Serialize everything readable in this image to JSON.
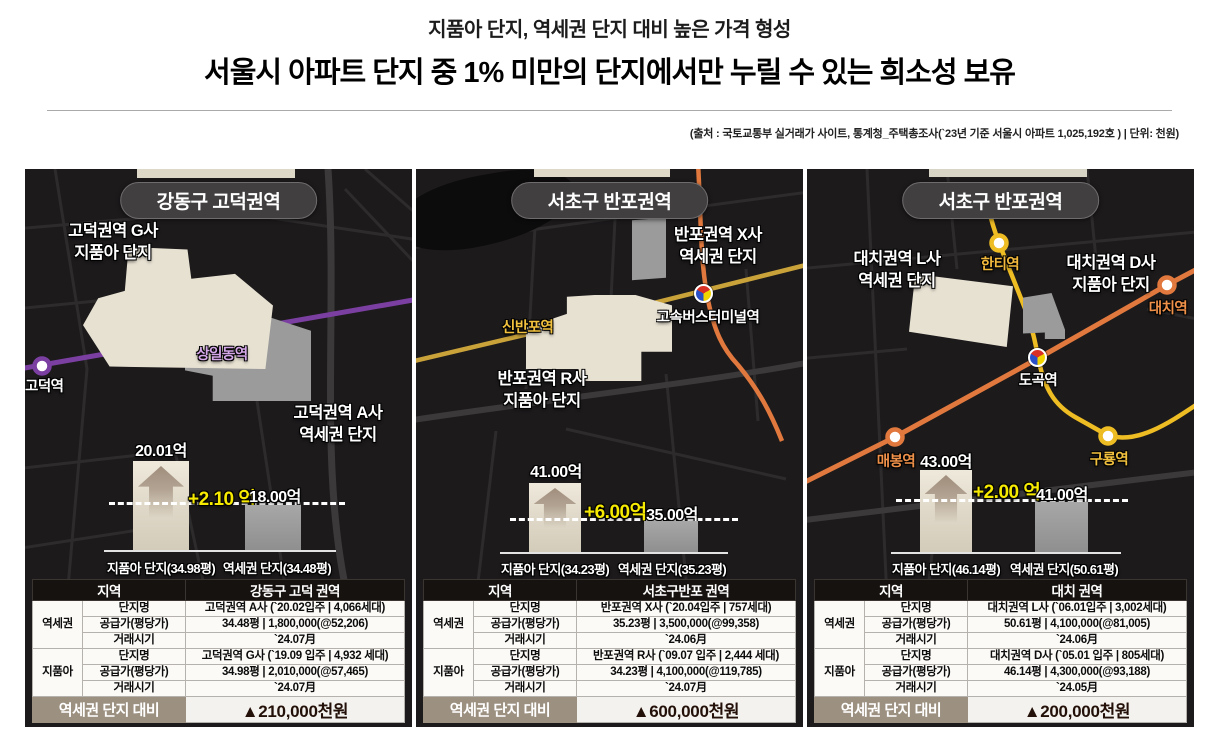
{
  "header": {
    "subtitle": "지품아 단지, 역세권 단지 대비 높은 가격 형성",
    "title": "서울시 아파트 단지 중 1% 미만의 단지에서만 누릴 수 있는 희소성 보유",
    "source": "(출처 : 국토교통부 실거래가 사이트, 통계청_주택총조사(`23년 기준 서울시 아파트 1,025,192호 ) | 단위: 천원)"
  },
  "colors": {
    "diff_highlight": "#f6ea00",
    "line_purple": "#7b3fa2",
    "line_gold": "#c9a23a",
    "line_yellow": "#eebc23",
    "line_orange": "#e1793e",
    "bar_premium_cream": "#e7e0d0",
    "bar_station_gray": "#9a9a9a",
    "table_footer_bg": "#9c9080",
    "map_bg": "#1c1a1b"
  },
  "panels": [
    {
      "title": "강동구 고덕권역",
      "map": {
        "area_labels": [
          {
            "text": "고덕권역 G사\n지품아 단지"
          },
          {
            "text": "고덕권역 A사\n역세권 단지"
          }
        ],
        "stations": [
          {
            "name": "고덕역"
          },
          {
            "name": "상일동역"
          }
        ]
      },
      "chart": {
        "left_value": "20.01억",
        "diff": "+2.10 억",
        "right_value": "18.00억",
        "left_label": "지품아 단지(34.98평)",
        "right_label": "역세권 단지(34.48평)"
      },
      "table": {
        "region_header": "지역",
        "region_value": "강동구 고덕 권역",
        "groups": [
          {
            "name": "역세권",
            "rows": [
              {
                "label": "단지명",
                "value": "고덕권역 A사 (`20.02입주 | 4,066세대)"
              },
              {
                "label": "공급가(평당가)",
                "value": "34.48평 | 1,800,000(@52,206)"
              },
              {
                "label": "거래시기",
                "value": "`24.07月"
              }
            ]
          },
          {
            "name": "지품아",
            "rows": [
              {
                "label": "단지명",
                "value": "고덕권역 G사 (`19.09 입주 | 4,932 세대)"
              },
              {
                "label": "공급가(평당가)",
                "value": "34.98평 | 2,010,000(@57,465)"
              },
              {
                "label": "거래시기",
                "value": "`24.07月"
              }
            ]
          }
        ],
        "footer_label": "역세권 단지 대비",
        "footer_value": "▲210,000천원"
      }
    },
    {
      "title": "서초구 반포권역",
      "map": {
        "area_labels": [
          {
            "text": "반포권역 X사\n역세권 단지"
          },
          {
            "text": "반포권역 R사\n지품아 단지"
          }
        ],
        "stations": [
          {
            "name": "신반포역"
          },
          {
            "name": "고속버스터미널역"
          }
        ]
      },
      "chart": {
        "left_value": "41.00억",
        "diff": "+6.00억",
        "right_value": "35.00억",
        "left_label": "지품아 단지(34.23평)",
        "right_label": "역세권 단지(35.23평)"
      },
      "table": {
        "region_header": "지역",
        "region_value": "서초구반포 권역",
        "groups": [
          {
            "name": "역세권",
            "rows": [
              {
                "label": "단지명",
                "value": "반포권역 X사 (`20.04입주 | 757세대)"
              },
              {
                "label": "공급가(평당가)",
                "value": "35.23평 | 3,500,000(@99,358)"
              },
              {
                "label": "거래시기",
                "value": "`24.06月"
              }
            ]
          },
          {
            "name": "지품아",
            "rows": [
              {
                "label": "단지명",
                "value": "반포권역 R사 (`09.07 입주 | 2,444 세대)"
              },
              {
                "label": "공급가(평당가)",
                "value": "34.23평 | 4,100,000(@119,785)"
              },
              {
                "label": "거래시기",
                "value": "`24.07月"
              }
            ]
          }
        ],
        "footer_label": "역세권 단지 대비",
        "footer_value": "▲600,000천원"
      }
    },
    {
      "title": "서초구 반포권역",
      "map": {
        "area_labels": [
          {
            "text": "대치권역 L사\n역세권 단지"
          },
          {
            "text": "대치권역 D사\n지품아 단지"
          }
        ],
        "stations": [
          {
            "name": "한티역"
          },
          {
            "name": "대치역"
          },
          {
            "name": "도곡역"
          },
          {
            "name": "매봉역"
          },
          {
            "name": "구룡역"
          }
        ]
      },
      "chart": {
        "left_value": "43.00억",
        "diff": "+2.00 억",
        "right_value": "41.00억",
        "left_label": "지품아 단지(46.14평)",
        "right_label": "역세권 단지(50.61평)"
      },
      "table": {
        "region_header": "지역",
        "region_value": "대치 권역",
        "groups": [
          {
            "name": "역세권",
            "rows": [
              {
                "label": "단지명",
                "value": "대치권역 L사 (`06.01입주 | 3,002세대)"
              },
              {
                "label": "공급가(평당가)",
                "value": "50.61평 | 4,100,000(@81,005)"
              },
              {
                "label": "거래시기",
                "value": "`24.06月"
              }
            ]
          },
          {
            "name": "지품아",
            "rows": [
              {
                "label": "단지명",
                "value": "대치권역 D사 (`05.01 입주 | 805세대)"
              },
              {
                "label": "공급가(평당가)",
                "value": "46.14평 | 4,300,000(@93,188)"
              },
              {
                "label": "거래시기",
                "value": "`24.05月"
              }
            ]
          }
        ],
        "footer_label": "역세권 단지 대비",
        "footer_value": "▲200,000천원"
      }
    }
  ],
  "chart_data": [
    {
      "type": "bar",
      "title": "강동구 고덕권역",
      "categories": [
        "지품아 단지(34.98평)",
        "역세권 단지(34.48평)"
      ],
      "values": [
        20.01,
        18.0
      ],
      "unit": "억",
      "diff_label": "+2.10 억",
      "footer_note": "▲210,000천원",
      "legend_position": "none",
      "grid": false
    },
    {
      "type": "bar",
      "title": "서초구 반포권역",
      "categories": [
        "지품아 단지(34.23평)",
        "역세권 단지(35.23평)"
      ],
      "values": [
        41.0,
        35.0
      ],
      "unit": "억",
      "diff_label": "+6.00억",
      "footer_note": "▲600,000천원",
      "legend_position": "none",
      "grid": false
    },
    {
      "type": "bar",
      "title": "대치 권역",
      "categories": [
        "지품아 단지(46.14평)",
        "역세권 단지(50.61평)"
      ],
      "values": [
        43.0,
        41.0
      ],
      "unit": "억",
      "diff_label": "+2.00 억",
      "footer_note": "▲200,000천원",
      "legend_position": "none",
      "grid": false
    }
  ]
}
